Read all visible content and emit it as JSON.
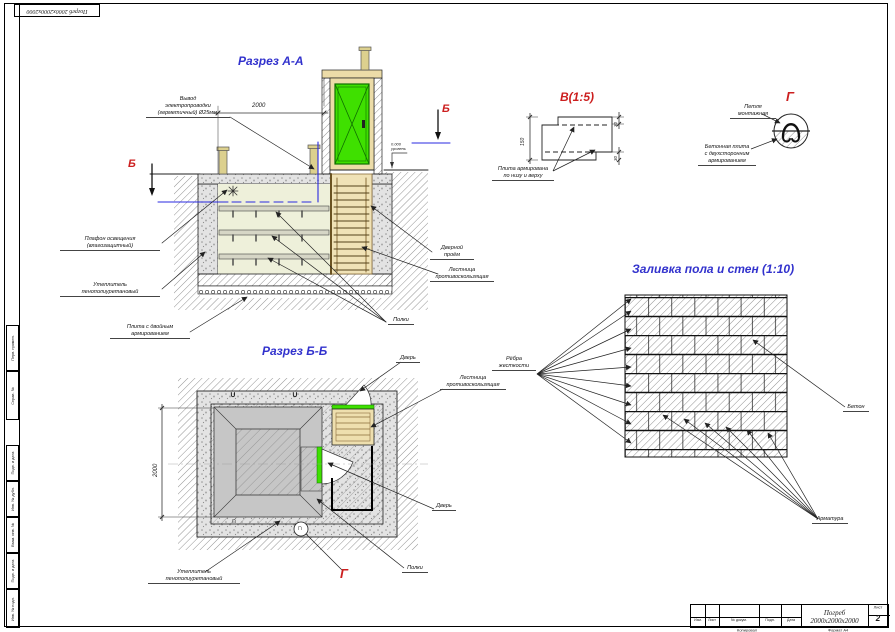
{
  "colors": {
    "accent-blue": "#3232cd",
    "accent-red": "#cc1f1f",
    "door-green": "#3fe000",
    "door-green-dark": "#0f7000",
    "wire-blue": "#2a2ae0",
    "wood-tan": "#ecdca8",
    "interior": "#eef0da"
  },
  "stamp": {
    "text": "Погреб 2000х2000х2000"
  },
  "margin_labels": [
    "Перв. примен.",
    "Справ. №",
    "Подп. и дата",
    "Инв. № дубл.",
    "Взам. инв. №",
    "Подп. и дата",
    "Инв. № подл."
  ],
  "section_aa": {
    "title": "Разрез А-А",
    "section_marker_left": "Б",
    "section_marker_right": "Б",
    "dim_width": "2000",
    "level_mark": "0.000\nуровень",
    "labels": {
      "wiring": "Вывод\nэлектропроводки\n(герметичный) Ø25мм.",
      "lamp": "Плафон освещения\n(влагозащитный)",
      "insulation": "Утеплитель\nпенополиуретановый",
      "slab": "Плита с двойным\nармированием",
      "shelves": "Полки",
      "door_opening": "Дверной\nпроём",
      "ladder": "Лестница\nпротивоскользящая"
    }
  },
  "section_bb": {
    "title": "Разрез Б-Б",
    "dim_width": "2000",
    "detail_callout": "Г",
    "loop_marks": {
      "top1": "∪",
      "top2": "∪",
      "bottom": "∩",
      "circled": "∩"
    },
    "labels": {
      "door_entry": "Дверь",
      "ladder": "Лестница\nпротивоскользящая",
      "door_inner": "Дверь",
      "shelves": "Полки",
      "insulation": "Утеплитель\nпенополиуретановый"
    }
  },
  "detail_v": {
    "title": "В(1:5)",
    "dim_height": "150",
    "dim_cover_top": "30",
    "dim_cover_bottom": "30",
    "label": "Плита армирована\nпо низу и верху"
  },
  "detail_g": {
    "title": "Г",
    "labels": {
      "loop": "Петля\nмонтажная",
      "slab": "Бетонная плита\nс двухсторонним\nармированием"
    }
  },
  "pour_plan": {
    "title": "Заливка пола и стен (1:10)",
    "labels": {
      "ribs": "Рёбра\nжесткости",
      "concrete": "Бетон",
      "rebar": "Арматура"
    }
  },
  "title_block": {
    "project": "Погреб 2000х2000х2000",
    "columns": [
      "Изм.",
      "Лист",
      "№ докум.",
      "Подп.",
      "Дата"
    ],
    "sheet_label": "Лист",
    "sheet_number": "2",
    "footer_left": "Копировал",
    "footer_right": "Формат А4"
  }
}
